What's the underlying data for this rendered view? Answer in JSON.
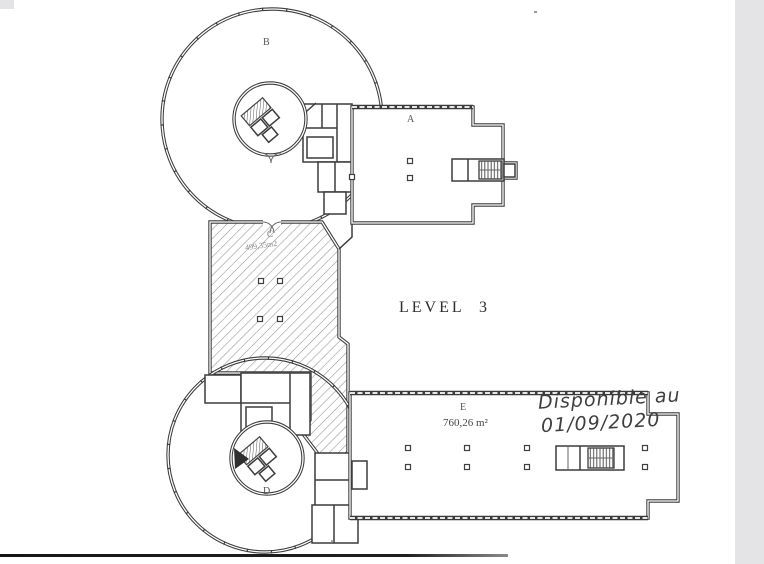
{
  "document": {
    "type": "floor-plan-scan",
    "title": "LEVEL 3"
  },
  "plan": {
    "title": "LEVEL 3",
    "sections": {
      "a": {
        "label": "A"
      },
      "b": {
        "label": "B"
      },
      "c": {
        "label": "C",
        "area": "499,35m2"
      },
      "d": {
        "label": "D"
      },
      "e": {
        "label": "E",
        "area": "760,26 m²"
      }
    },
    "annotation": {
      "line1": "Disponible au",
      "line2": "01/09/2020"
    }
  },
  "colors": {
    "paper": "#ffffff",
    "wall": "#3c3c3c",
    "hatch": "#9a9a9a",
    "handwriting_ink": "#3f3f3f",
    "scan_strip": "#e4e4e6",
    "scan_line": "#1a1a1a"
  }
}
